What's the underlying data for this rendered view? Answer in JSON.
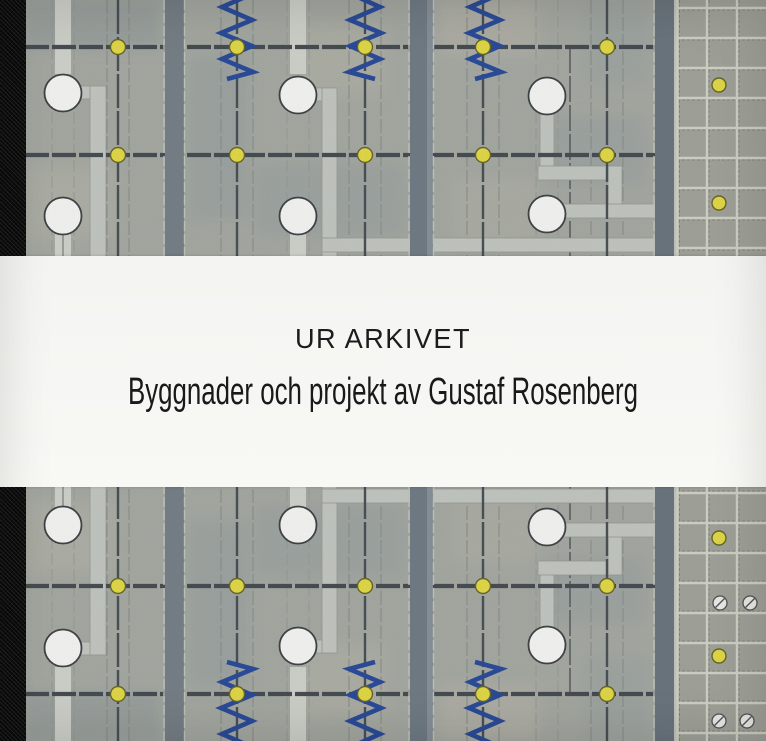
{
  "cover": {
    "title": "UR ARKIVET",
    "subtitle": "Byggnader och projekt av Gustaf Rosenberg"
  },
  "artwork": {
    "kind": "watercolor architectural site plan, mirrored top and bottom of title band",
    "elements": {
      "lamp-dot": {
        "count": 24,
        "color": "#e9e04b"
      },
      "tree-circle": {
        "count": 12,
        "color": "#fcfcfa"
      },
      "hedge-zigzag": {
        "count": 6,
        "color": "#2d4f9f"
      },
      "screw-marker": {
        "count": 4,
        "color": "#f4f4f0"
      },
      "paving-grid": {
        "color": "#a7a9a0"
      }
    },
    "colors": {
      "band_background": "#f6f6f4",
      "plan_background": "#abafa8",
      "spine_black": "#0d0d0d",
      "road_gray": "#4a5156",
      "avenue_gray": "#76808a",
      "walkway_light": "#c9cdc7",
      "hedge_blue": "#2d4f9f",
      "lamp_yellow": "#e9e04b",
      "title_text": "#1c1c1c"
    }
  }
}
